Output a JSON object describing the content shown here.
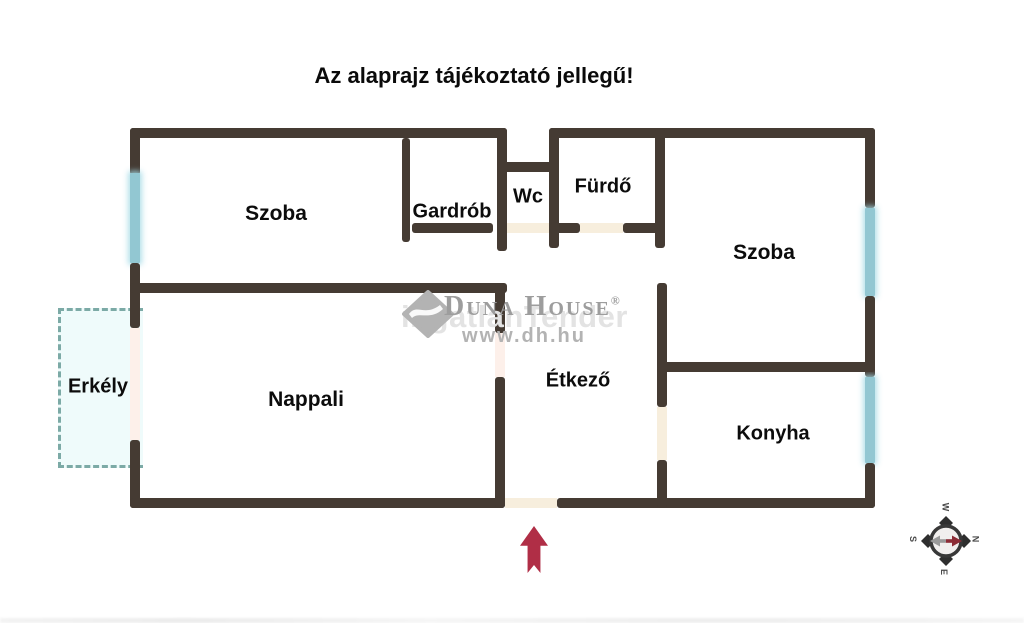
{
  "title": "Az alaprajz tájékoztató jellegű!",
  "rooms": {
    "szoba_left": "Szoba",
    "gardrob": "Gardrób",
    "wc": "Wc",
    "furdo": "Fürdő",
    "szoba_right": "Szoba",
    "erkely": "Erkély",
    "nappali": "Nappali",
    "etkezo": "Étkező",
    "konyha": "Konyha"
  },
  "watermark": {
    "brand": "Duna House",
    "registered": "®",
    "ghost": "ingatlanTender",
    "url": "www.dh.hu"
  },
  "compass": {
    "top": "W",
    "right": "N",
    "bottom": "E",
    "left": "S"
  },
  "colors": {
    "wall": "#453b33",
    "window": "#92c7d2",
    "balcony_line": "#7caaa6",
    "door_cream": "#f7eedd",
    "door_pink": "#fdf0ea",
    "arrow": "#b02e46",
    "watermark_gray": "#9d9d9d"
  }
}
